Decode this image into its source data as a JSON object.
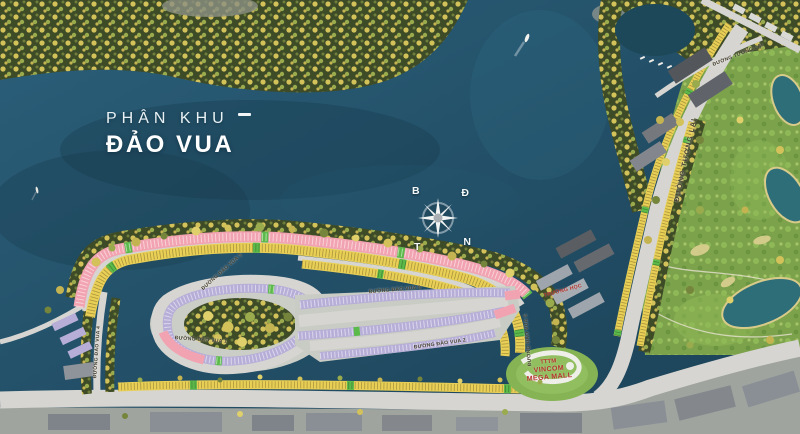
{
  "title": {
    "kicker": "PHÂN KHU",
    "name": "ĐẢO VUA"
  },
  "compass": {
    "north": "B",
    "east": "Đ",
    "west": "T",
    "south": "N"
  },
  "streets": [
    {
      "label": "ĐƯỜNG ĐẢO VUA 3"
    },
    {
      "label": "ĐƯỜNG ĐẢO VUA 8"
    },
    {
      "label": "ĐƯỜNG ĐẢO VUA 1"
    },
    {
      "label": "ĐƯỜNG ĐẢO VUA 2"
    },
    {
      "label": "ĐƯỜNG ĐẢO VUA 5"
    },
    {
      "label": "ĐƯỜNG ĐẢO VUA 4"
    },
    {
      "label": "ĐƯỜNG TƯƠNG LAI"
    },
    {
      "label": "ĐƯỜNG TƯƠNG LAI"
    }
  ],
  "places": {
    "mall": {
      "line1": "TTTM",
      "line2": "VINCOM",
      "line3": "MEGA MALL"
    },
    "school": {
      "label": "TRƯỜNG HỌC"
    }
  },
  "palette": {
    "water": "#1D4A61",
    "water_deep": "#16384A",
    "forest": "#3E4B27",
    "tree_yellow": "#D3C25A",
    "golf_green": "#7CA24B",
    "pond_teal": "#2E6E78",
    "road_gray": "#D6D5D1",
    "row_pink": "#F2A3B1",
    "row_yellow": "#E9CF55",
    "row_purple": "#B7AED8",
    "park_green": "#5CBA4A",
    "building_gray": "#84888D",
    "accent_red": "#B5342C",
    "title_white": "#FFFFFF"
  }
}
